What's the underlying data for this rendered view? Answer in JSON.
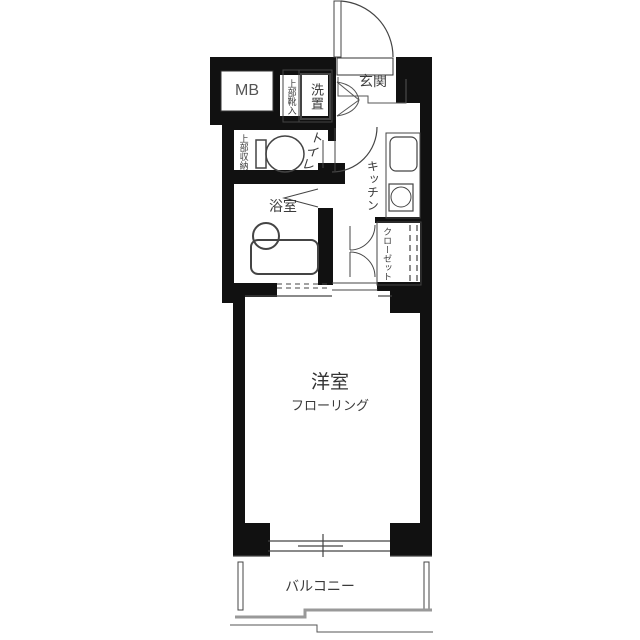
{
  "floorplan": {
    "title": "1K apartment floor plan",
    "labels": {
      "meter_box": "MB",
      "entrance": "玄関",
      "washer_place": "洗置",
      "upper_shoe_storage": "上部靴入",
      "toilet": "トイレ",
      "upper_storage": "上部収納",
      "bathroom": "浴室",
      "kitchen": "キッチン",
      "closet": "クローゼット",
      "main_room": "洋室",
      "main_room_floor": "フローリング",
      "balcony": "バルコニー"
    },
    "colors": {
      "wall": "#111111",
      "line": "#444444",
      "railing": "#999999",
      "background": "#ffffff"
    }
  }
}
